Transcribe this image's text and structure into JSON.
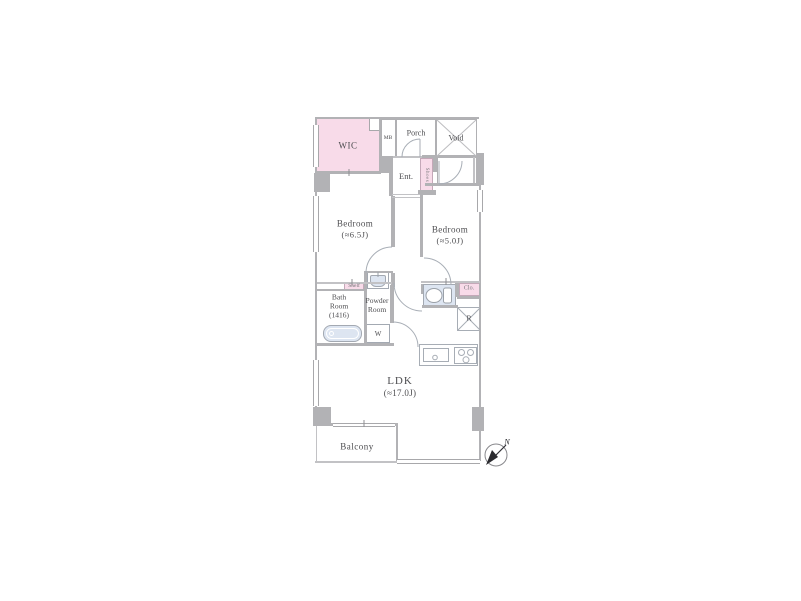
{
  "floorplan": {
    "rooms": {
      "wic": {
        "label": "WIC"
      },
      "meter_box": {
        "label": "MB"
      },
      "porch": {
        "label": "Porch"
      },
      "void": {
        "label": "Void"
      },
      "entrance": {
        "label": "Ent."
      },
      "shoes": {
        "label": "Shoes"
      },
      "bedroom_main": {
        "label": "Bedroom",
        "size": "(≈6.5J)"
      },
      "bedroom_second": {
        "label": "Bedroom",
        "size": "(≈5.0J)"
      },
      "shelf": {
        "label": "Shelf"
      },
      "bathroom": {
        "line1": "Bath",
        "line2": "Room",
        "line3": "(1416)"
      },
      "powder_room": {
        "line1": "Powder",
        "line2": "Room"
      },
      "washer": {
        "label": "W"
      },
      "closet": {
        "label": "Clo."
      },
      "refrigerator": {
        "label": "R"
      },
      "ldk": {
        "label": "LDK",
        "size": "(≈17.0J)"
      },
      "balcony": {
        "label": "Balcony"
      }
    },
    "compass": {
      "north_label": "N"
    },
    "colors": {
      "accent_pink": "#f8dbe9",
      "fixture_blue": "#dde5f1",
      "wall_gray": "#b2b2b5",
      "text_gray": "#4d4d50"
    }
  }
}
